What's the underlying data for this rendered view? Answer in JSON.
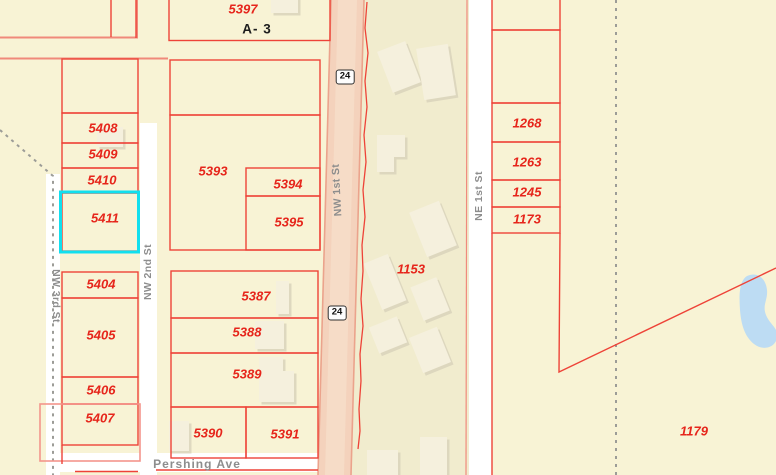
{
  "zone_label": "A- 3",
  "route_shield": "24",
  "selected_parcel": "5411",
  "parcels": {
    "p5397": "5397",
    "p5408": "5408",
    "p5409": "5409",
    "p5410": "5410",
    "p5411": "5411",
    "p5404": "5404",
    "p5405": "5405",
    "p5406": "5406",
    "p5407": "5407",
    "p5393": "5393",
    "p5394": "5394",
    "p5395": "5395",
    "p5387": "5387",
    "p5388": "5388",
    "p5389": "5389",
    "p5390": "5390",
    "p5391": "5391",
    "p1268": "1268",
    "p1263": "1263",
    "p1245": "1245",
    "p1173": "1173",
    "p1153": "1153",
    "p1179": "1179"
  },
  "streets": {
    "nw3rd": "NW 3rd St",
    "nw2nd": "NW 2nd St",
    "nw1st": "NW 1st St",
    "ne1st": "NE 1st St",
    "pershing": "Pershing Ave"
  },
  "colors": {
    "parcel_line": "#ee4338",
    "highlight": "#12dfee",
    "road_fill": "#f6dcc7",
    "water": "#bddcf3",
    "background": "#f8f3d5",
    "label_red": "#e6251b",
    "street_gray": "#8d8d8d"
  }
}
